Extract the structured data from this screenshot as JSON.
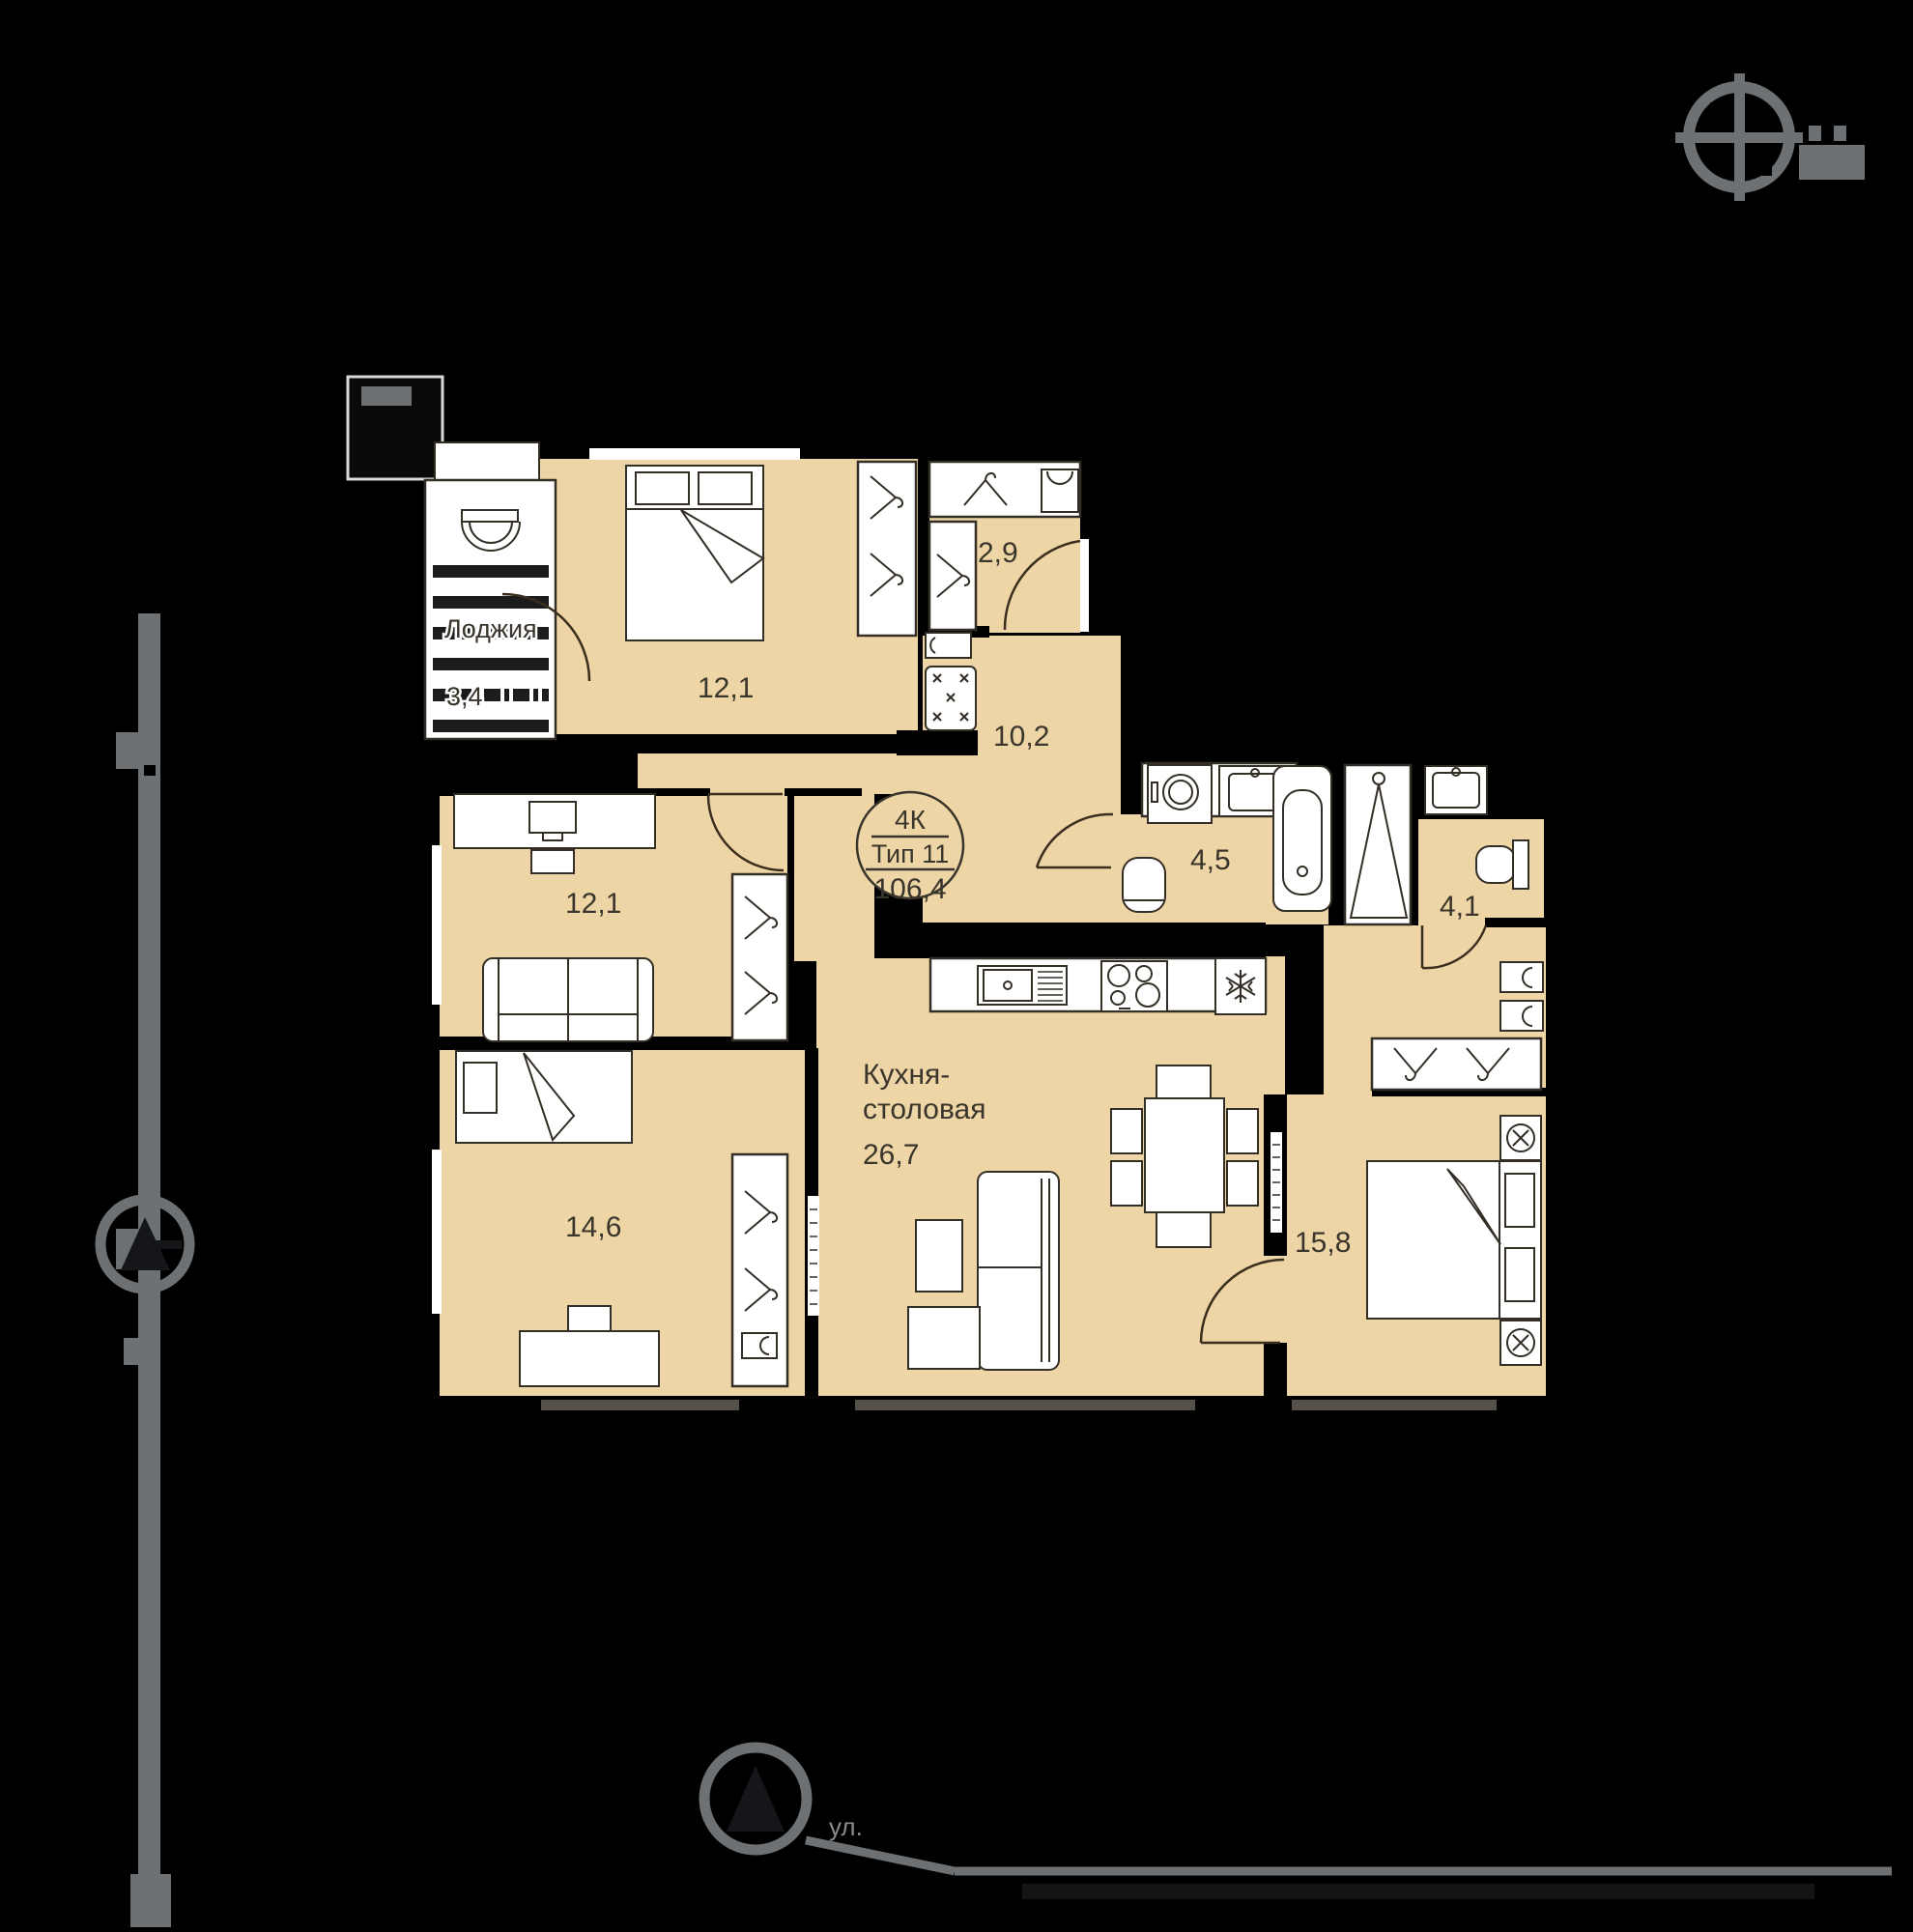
{
  "plan": {
    "info": {
      "rooms_type": "4К",
      "plan_type": "Тип 11",
      "total_area": "106,4"
    },
    "rooms": [
      {
        "id": "bedroom-top",
        "area": "12,1"
      },
      {
        "id": "wardrobe",
        "area": "2,9"
      },
      {
        "id": "hallway",
        "area": "10,2"
      },
      {
        "id": "bathroom",
        "area": "4,5"
      },
      {
        "id": "toilet",
        "area": "4,1"
      },
      {
        "id": "room-left",
        "area": "12,1"
      },
      {
        "id": "kitchen-dining",
        "name_line1": "Кухня-",
        "name_line2": "столовая",
        "area": "26,7"
      },
      {
        "id": "room-bottom",
        "area": "14,6"
      },
      {
        "id": "bedroom-right",
        "area": "15,8"
      },
      {
        "id": "loggia",
        "name": "Лоджия",
        "area": "3,4"
      }
    ]
  },
  "site": {
    "street_prefix": "ул."
  },
  "colors": {
    "floor": "#eed5a5",
    "walls": "#000000",
    "site_gray": "#6e7173",
    "label": "#3a352c"
  }
}
